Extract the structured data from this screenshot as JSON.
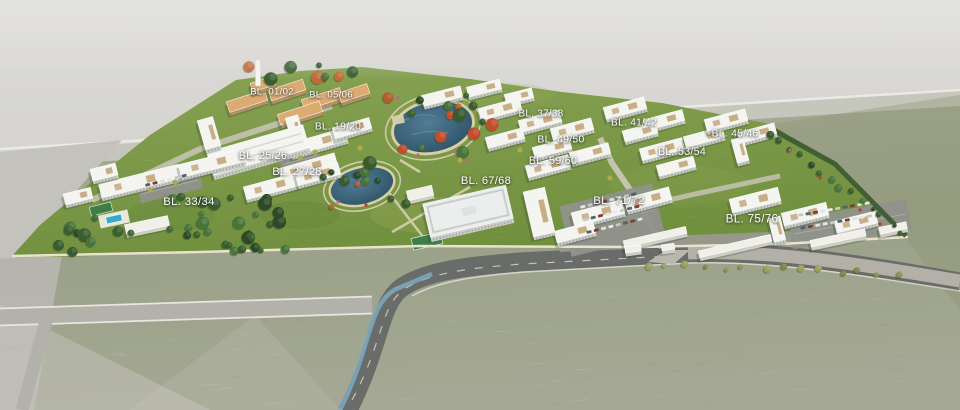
{
  "scene_title": "Residential masterplan aerial render",
  "labels": [
    {
      "text": "BL. 01/02",
      "x": 272,
      "y": 92
    },
    {
      "text": "BL. 05/06",
      "x": 331,
      "y": 95
    },
    {
      "text": "BL. 19/20",
      "x": 338,
      "y": 127
    },
    {
      "text": "BL. 25/26",
      "x": 263,
      "y": 156
    },
    {
      "text": "BL. 27/28",
      "x": 297,
      "y": 172
    },
    {
      "text": "BL. 33/34",
      "x": 189,
      "y": 202
    },
    {
      "text": "BL. 37/38",
      "x": 541,
      "y": 114
    },
    {
      "text": "BL. 49/50",
      "x": 561,
      "y": 140
    },
    {
      "text": "BL. 59/60",
      "x": 553,
      "y": 161
    },
    {
      "text": "BL. 67/68",
      "x": 486,
      "y": 181
    },
    {
      "text": "BL. 41/42",
      "x": 634,
      "y": 123
    },
    {
      "text": "BL. 45/46",
      "x": 735,
      "y": 134
    },
    {
      "text": "BL. 53/54",
      "x": 682,
      "y": 152
    },
    {
      "text": "BL. 71/72",
      "x": 619,
      "y": 201
    },
    {
      "text": "BL. 75/76",
      "x": 752,
      "y": 219
    }
  ],
  "colors": {
    "label_text": "#ffffff",
    "lawn": "#83a04f",
    "water": "#35607a",
    "pool": "#3aa9c9",
    "asphalt": "#696c68",
    "bike_lane": "#7ea9c2",
    "barren_land": "#9da389",
    "haze": "#d9d8d5",
    "building_white": "#f4f4f0",
    "building_tan": "#dcab72",
    "tree_green": "#3a5f2f"
  }
}
